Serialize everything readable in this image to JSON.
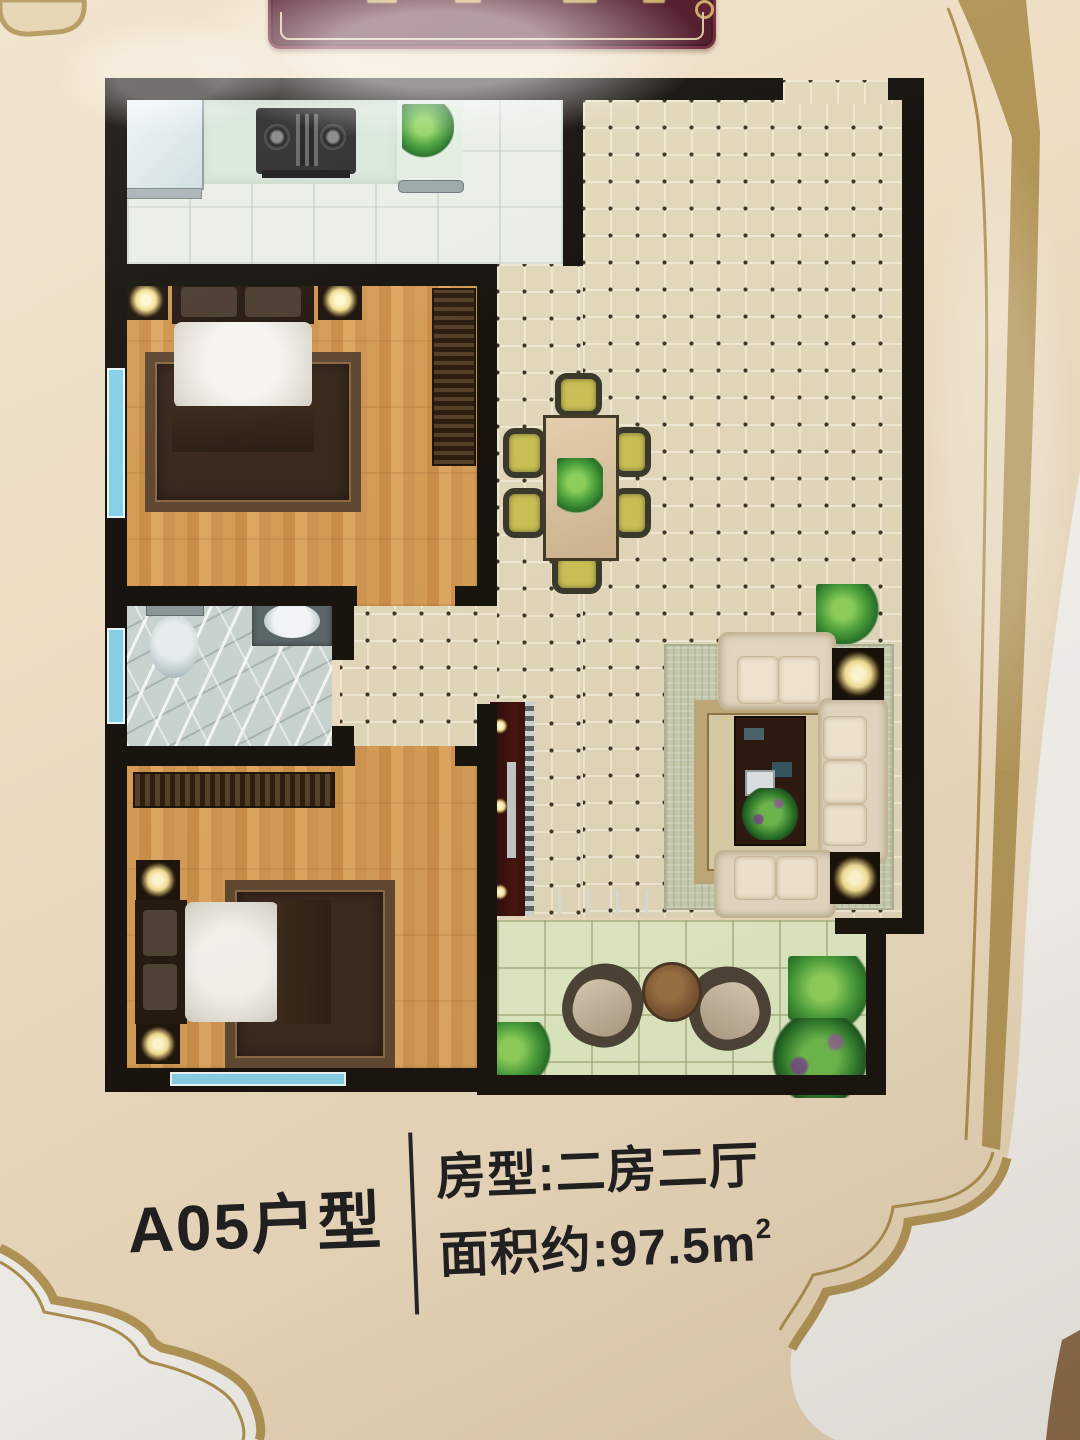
{
  "caption": {
    "unit_label": "A05户型",
    "room_type": "房型:二房二厅",
    "area_prefix": "面积约:97.5m",
    "area_sup": "2",
    "unit": "A05",
    "type_value": "二房二厅",
    "area_m2": 97.5
  },
  "banner": {
    "legible_text": ""
  },
  "rooms": [
    "kitchen",
    "bedroom-1",
    "bathroom",
    "bedroom-2",
    "dining-area",
    "living-room",
    "balcony"
  ],
  "furniture_icons": [
    "sink-icon",
    "stove-icon",
    "plant-icon",
    "bed-icon",
    "rug-icon",
    "lamp-icon",
    "wardrobe-icon",
    "toilet-icon",
    "washbasin-icon",
    "dining-table-icon",
    "chair-icon",
    "tv-cabinet-icon",
    "sofa-icon",
    "coffee-table-icon",
    "side-lamp-icon",
    "balcony-chair-icon",
    "round-table-icon",
    "shrub-icon"
  ],
  "colors": {
    "banner_maroon": "#4f1626",
    "frame_gold": "#b29557",
    "wall_black": "#17130e",
    "poster_cream": "#ecdcc2",
    "tile_tan": "#e1d7ba",
    "wood_floor": "#d49c55",
    "kitchen_floor": "#e9efe6",
    "bathroom_floor": "#c9d4d1",
    "balcony_floor": "#dde9c2",
    "window_blue": "#85d0e8",
    "text_black": "#1e1e20",
    "outside_white": "#f2f1ed"
  }
}
